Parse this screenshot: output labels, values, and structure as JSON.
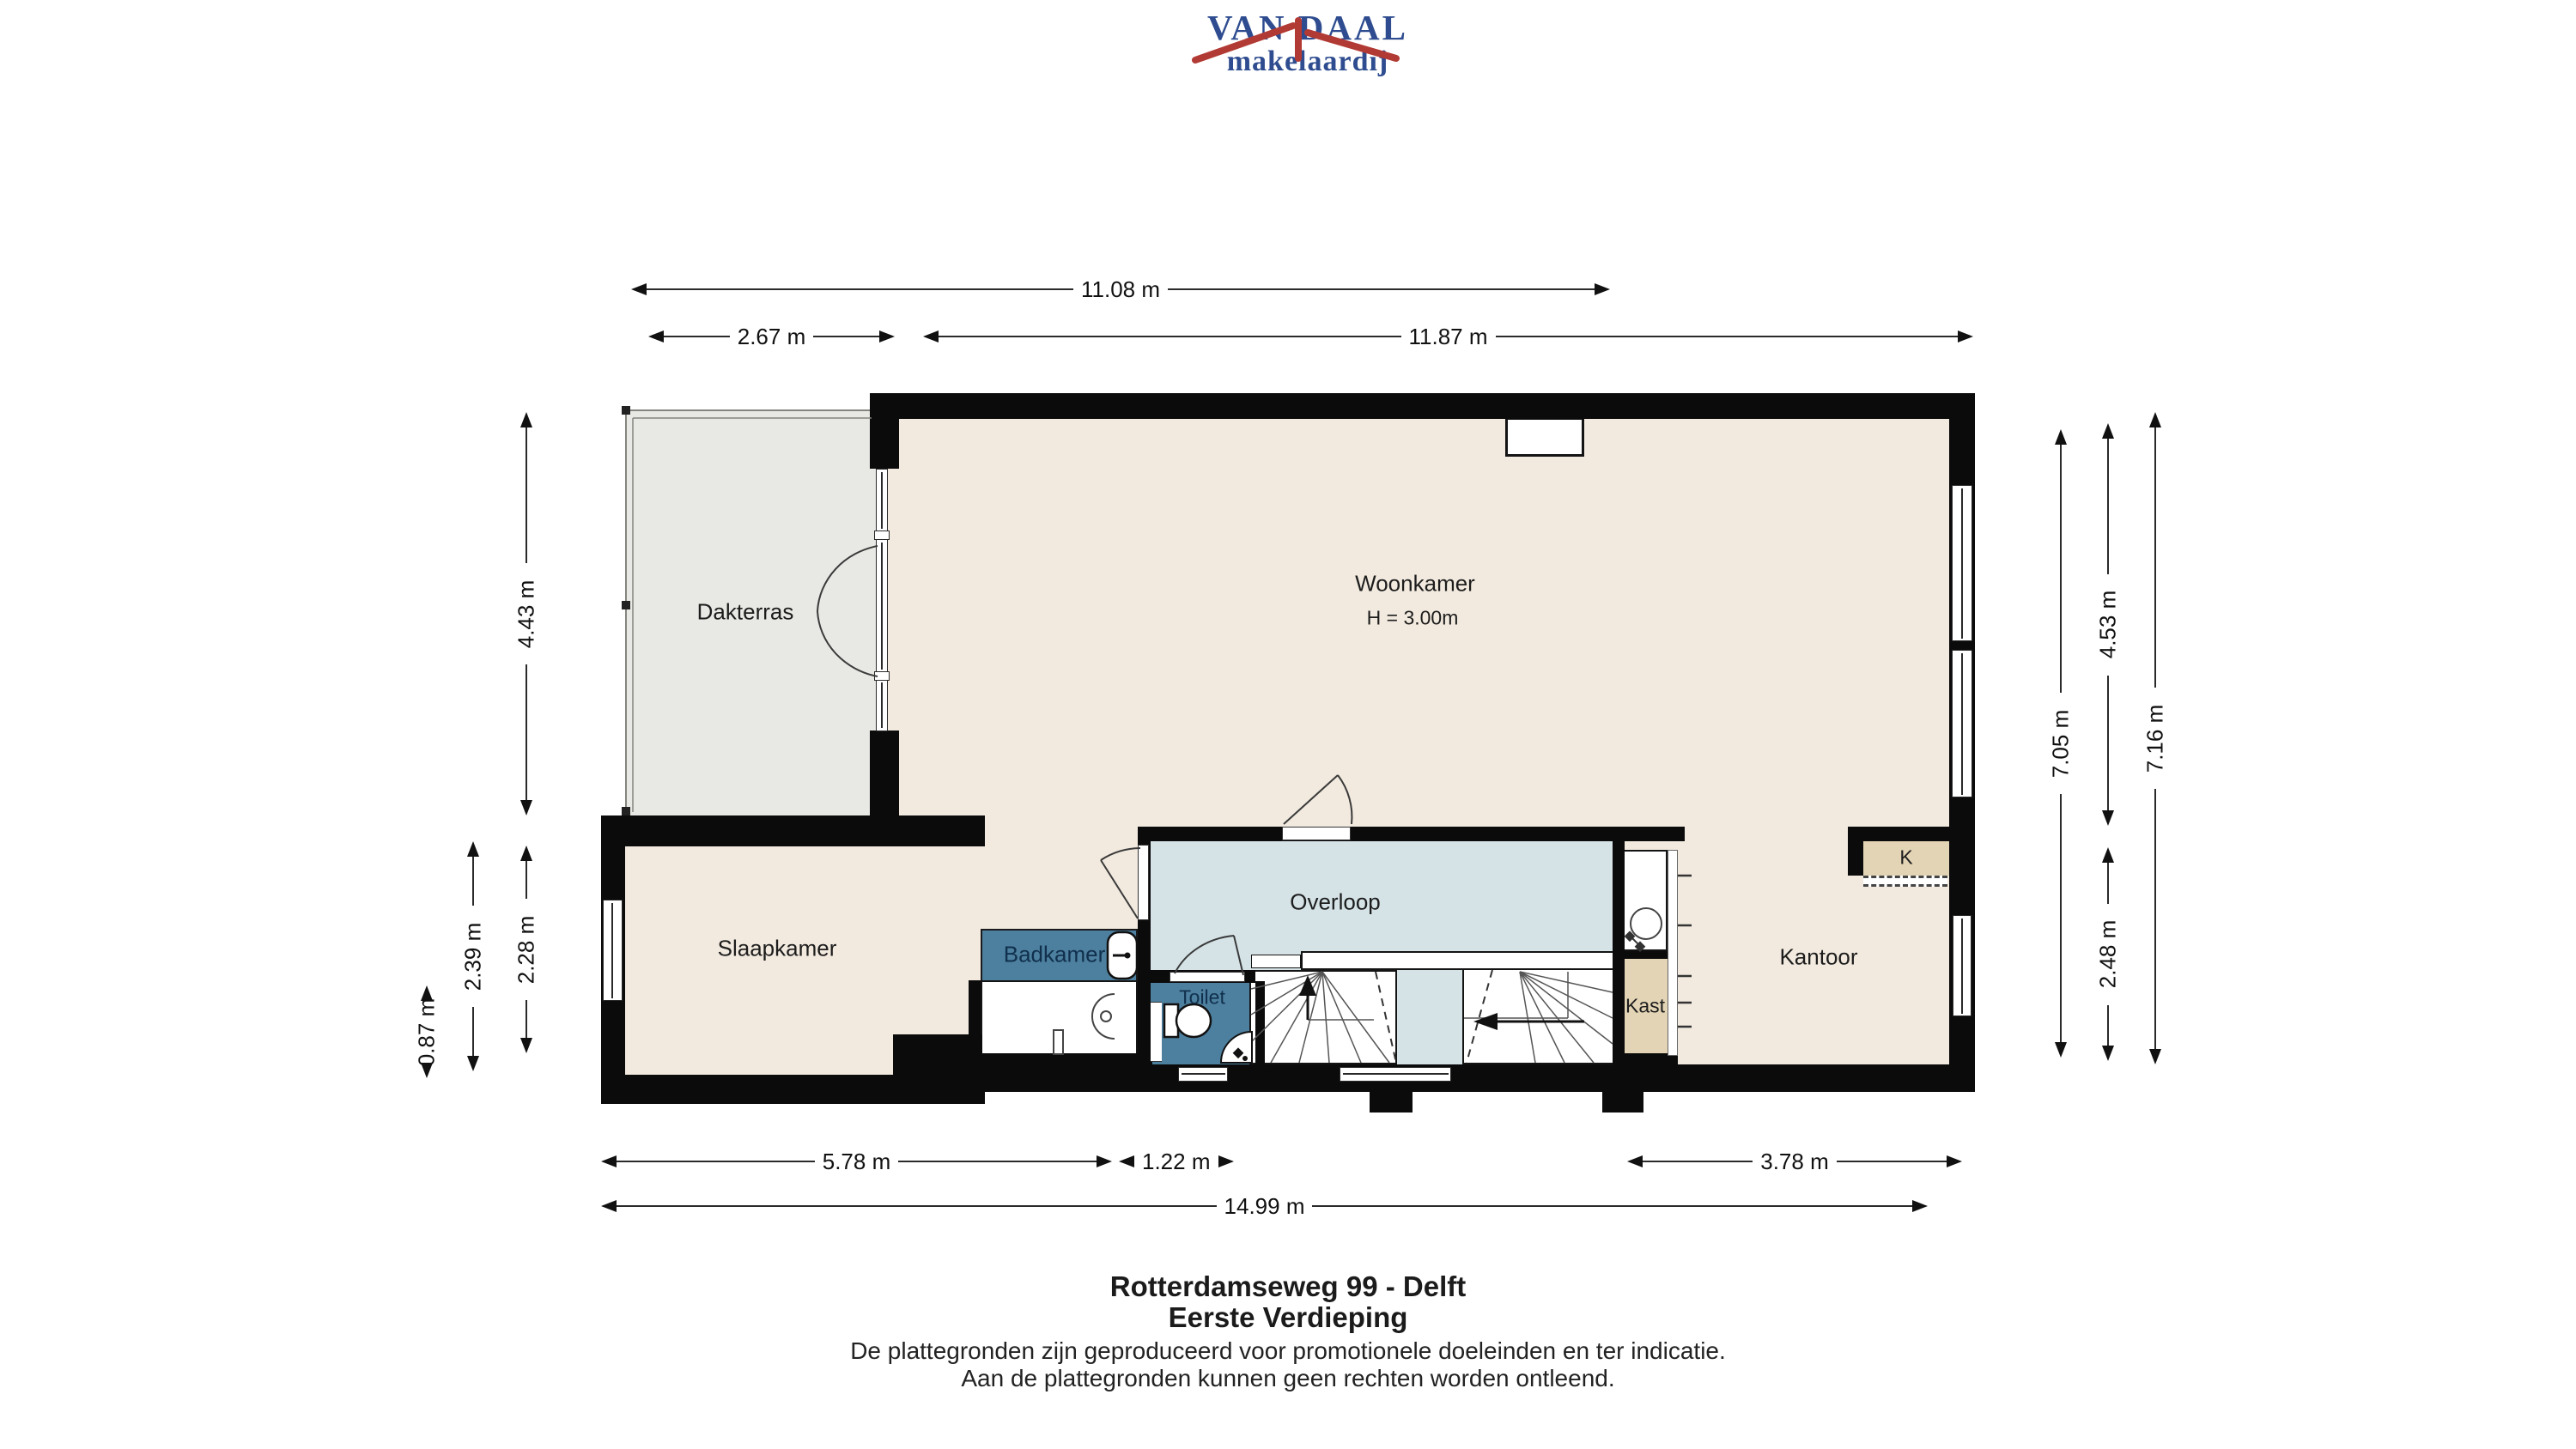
{
  "logo": {
    "name": "VAN DAAL",
    "tagline": "makelaardij"
  },
  "rooms": {
    "dakterras": "Dakterras",
    "woonkamer": "Woonkamer",
    "woonkamer_height": "H = 3.00m",
    "slaapkamer": "Slaapkamer",
    "badkamer": "Badkamer",
    "toilet": "Toilet",
    "overloop": "Overloop",
    "kast": "Kast",
    "kantoor": "Kantoor",
    "kitchen_k": "K"
  },
  "dimensions": {
    "top_total": "11.08 m",
    "top_left": "2.67 m",
    "top_right": "11.87 m",
    "bottom_left": "5.78 m",
    "bottom_mid": "1.22 m",
    "bottom_right": "3.78 m",
    "bottom_total": "14.99 m",
    "left_terrace": "4.43 m",
    "left_outer": "2.39 m",
    "left_inner": "2.28 m",
    "left_small": "0.87 m",
    "right_inner_total": "7.05 m",
    "right_upper": "4.53 m",
    "right_lower": "2.48 m",
    "right_total": "7.16 m"
  },
  "footer": {
    "address": "Rotterdamseweg 99 - Delft",
    "floor": "Eerste Verdieping",
    "disclaimer1": "De plattegronden zijn geproduceerd voor promotionele doeleinden en ter indicatie.",
    "disclaimer2": "Aan de plattegronden kunnen geen rechten worden ontleend."
  },
  "colors": {
    "logo_blue": "#2e4c8f",
    "logo_red": "#b23a34",
    "wall": "#0b0b0b",
    "room_beige": "#f2eadf",
    "terrace_grey": "#e8e9e4",
    "landing_blue": "#d5e3e7",
    "bath_blue": "#4d7f9e",
    "closet_tan": "#e2d4b4"
  }
}
